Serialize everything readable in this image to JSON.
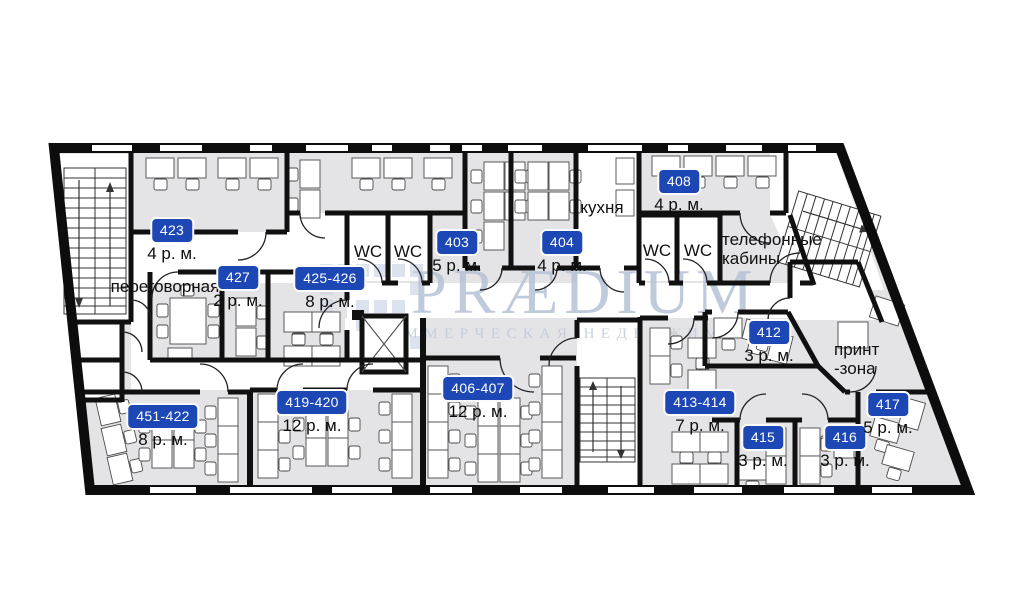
{
  "plan": {
    "watermark": {
      "brand": "PRÆDIUM",
      "tagline": "КОММЕРЧЕСКАЯ НЕДВИЖИМОСТЬ"
    },
    "colors": {
      "badge_blue": "#1c47b5",
      "wall_black": "#111111",
      "floor_gray": "#e4e4e6",
      "watermark_blue": "#b5c1d5"
    },
    "rooms": [
      {
        "number": "423",
        "capacity": "4 р. м."
      },
      {
        "number": "427",
        "capacity": "2 р. м."
      },
      {
        "number": "425-426",
        "capacity": "8 р. м."
      },
      {
        "number": "403",
        "capacity": "5 р. м."
      },
      {
        "number": "404",
        "capacity": "4 р. м."
      },
      {
        "number": "408",
        "capacity": "4 р. м."
      },
      {
        "number": "412",
        "capacity": "3 р. м."
      },
      {
        "number": "413-414",
        "capacity": "7 р. м."
      },
      {
        "number": "415",
        "capacity": "3 р. м."
      },
      {
        "number": "416",
        "capacity": "3 р. м."
      },
      {
        "number": "417",
        "capacity": "5 р. м."
      },
      {
        "number": "406-407",
        "capacity": "12 р. м."
      },
      {
        "number": "419-420",
        "capacity": "12 р. м."
      },
      {
        "number": "451-422",
        "capacity": "8 р. м."
      }
    ],
    "labels": {
      "meeting_room": "переговорная",
      "kitchen": "кухня",
      "wc": "WC",
      "phone_booths": [
        "телефонные",
        "кабины"
      ],
      "print_zone": [
        "принт",
        "-зона"
      ]
    }
  }
}
